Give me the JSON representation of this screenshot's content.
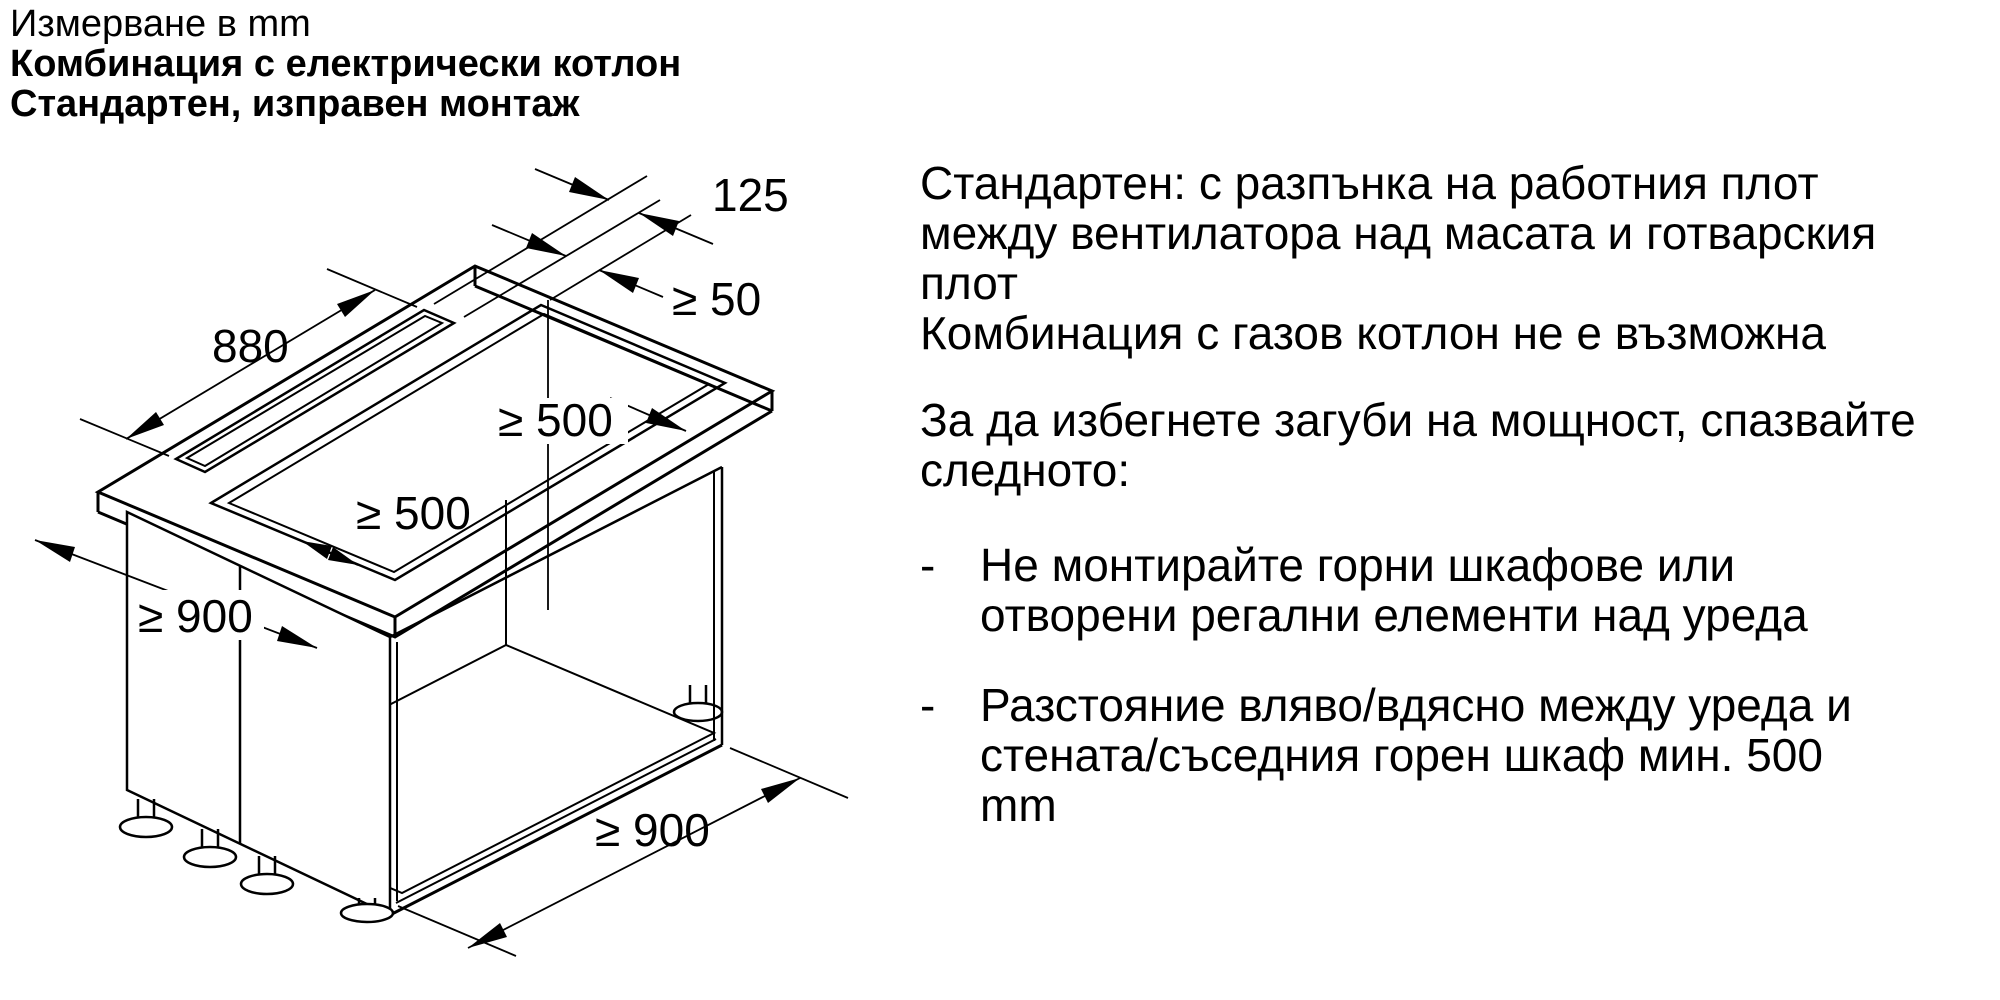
{
  "meta": {
    "background": "#ffffff",
    "ink": "#000000"
  },
  "header": {
    "measure_note": "Измерване в mm",
    "title_bold_1": "Комбинация с електрически котлон",
    "title_bold_2": "Стандартен, изправен монтаж"
  },
  "diagram": {
    "dim_slot_width": "125",
    "dim_slot_gap": "≥ 50",
    "dim_slot_length": "880",
    "dim_cutout_right": "≥ 500",
    "dim_cutout_front": "≥ 500",
    "dim_height": "≥ 900",
    "dim_width": "≥ 900"
  },
  "instructions": {
    "para_standard": [
      "Стандартен: с разпънка на работния плот",
      "между вентилатора над масата и готварския",
      "плот",
      "Комбинация с газов котлон не е възможна"
    ],
    "para_power": [
      "За да избегнете загуби на мощност, спазвайте",
      "следното:"
    ],
    "bullet_marker": "-",
    "bullet_1": [
      "Не монтирайте горни шкафове или",
      "отворени регални елементи над уреда"
    ],
    "bullet_2": [
      "Разстояние вляво/вдясно между уреда и",
      "стената/съседния горен шкаф мин. 500",
      "mm"
    ]
  }
}
